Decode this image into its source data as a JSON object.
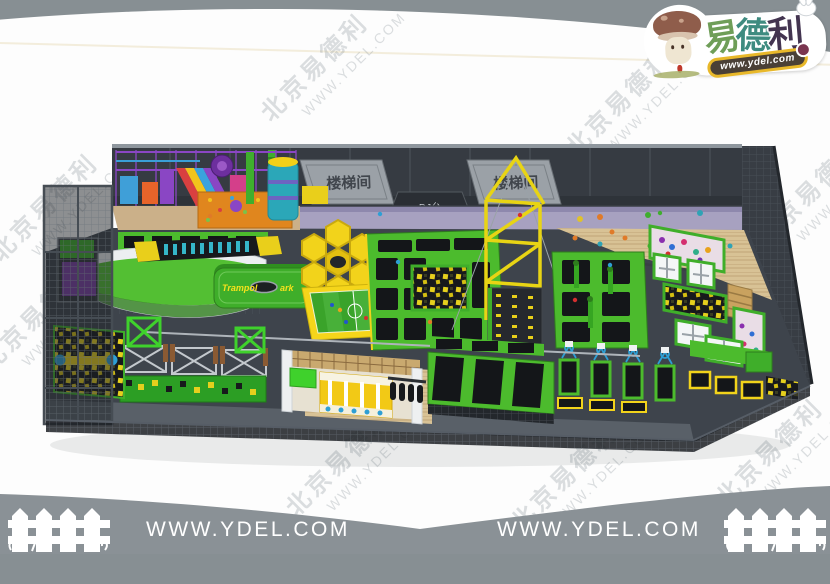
{
  "colors": {
    "background_gray": "#878f93",
    "footer_gray": "#8a9196",
    "canvas_white": "#fdfdfd",
    "park_green": "#4cbb2d",
    "accent_yellow": "#f2d31b",
    "kids_purple": "#7a3fa5",
    "walkway_lavender": "#a7a1c0",
    "logo_green": "#6f9e58",
    "logo_teal": "#3e8b80",
    "logo_dark_purple": "#433450"
  },
  "watermark": {
    "cn": "北京易德利",
    "url": "WWW.YDEL.COM"
  },
  "logo": {
    "brand_chars": [
      "易",
      "德",
      "利"
    ],
    "url": "www.ydel.com",
    "mascot_icon": "mushroom-mascot",
    "rabbit_icon": "rabbit"
  },
  "scene": {
    "stair_sign_left": "楼梯间",
    "stair_sign_right": "楼梯间",
    "dj_sign": "DJ台",
    "park_sign_prefix": "Trampol",
    "park_sign_suffix": "ark"
  },
  "footer": {
    "url_left": "WWW.YDEL.COM",
    "url_right": "WWW.YDEL.COM",
    "fence_icon": "picket-fence"
  }
}
